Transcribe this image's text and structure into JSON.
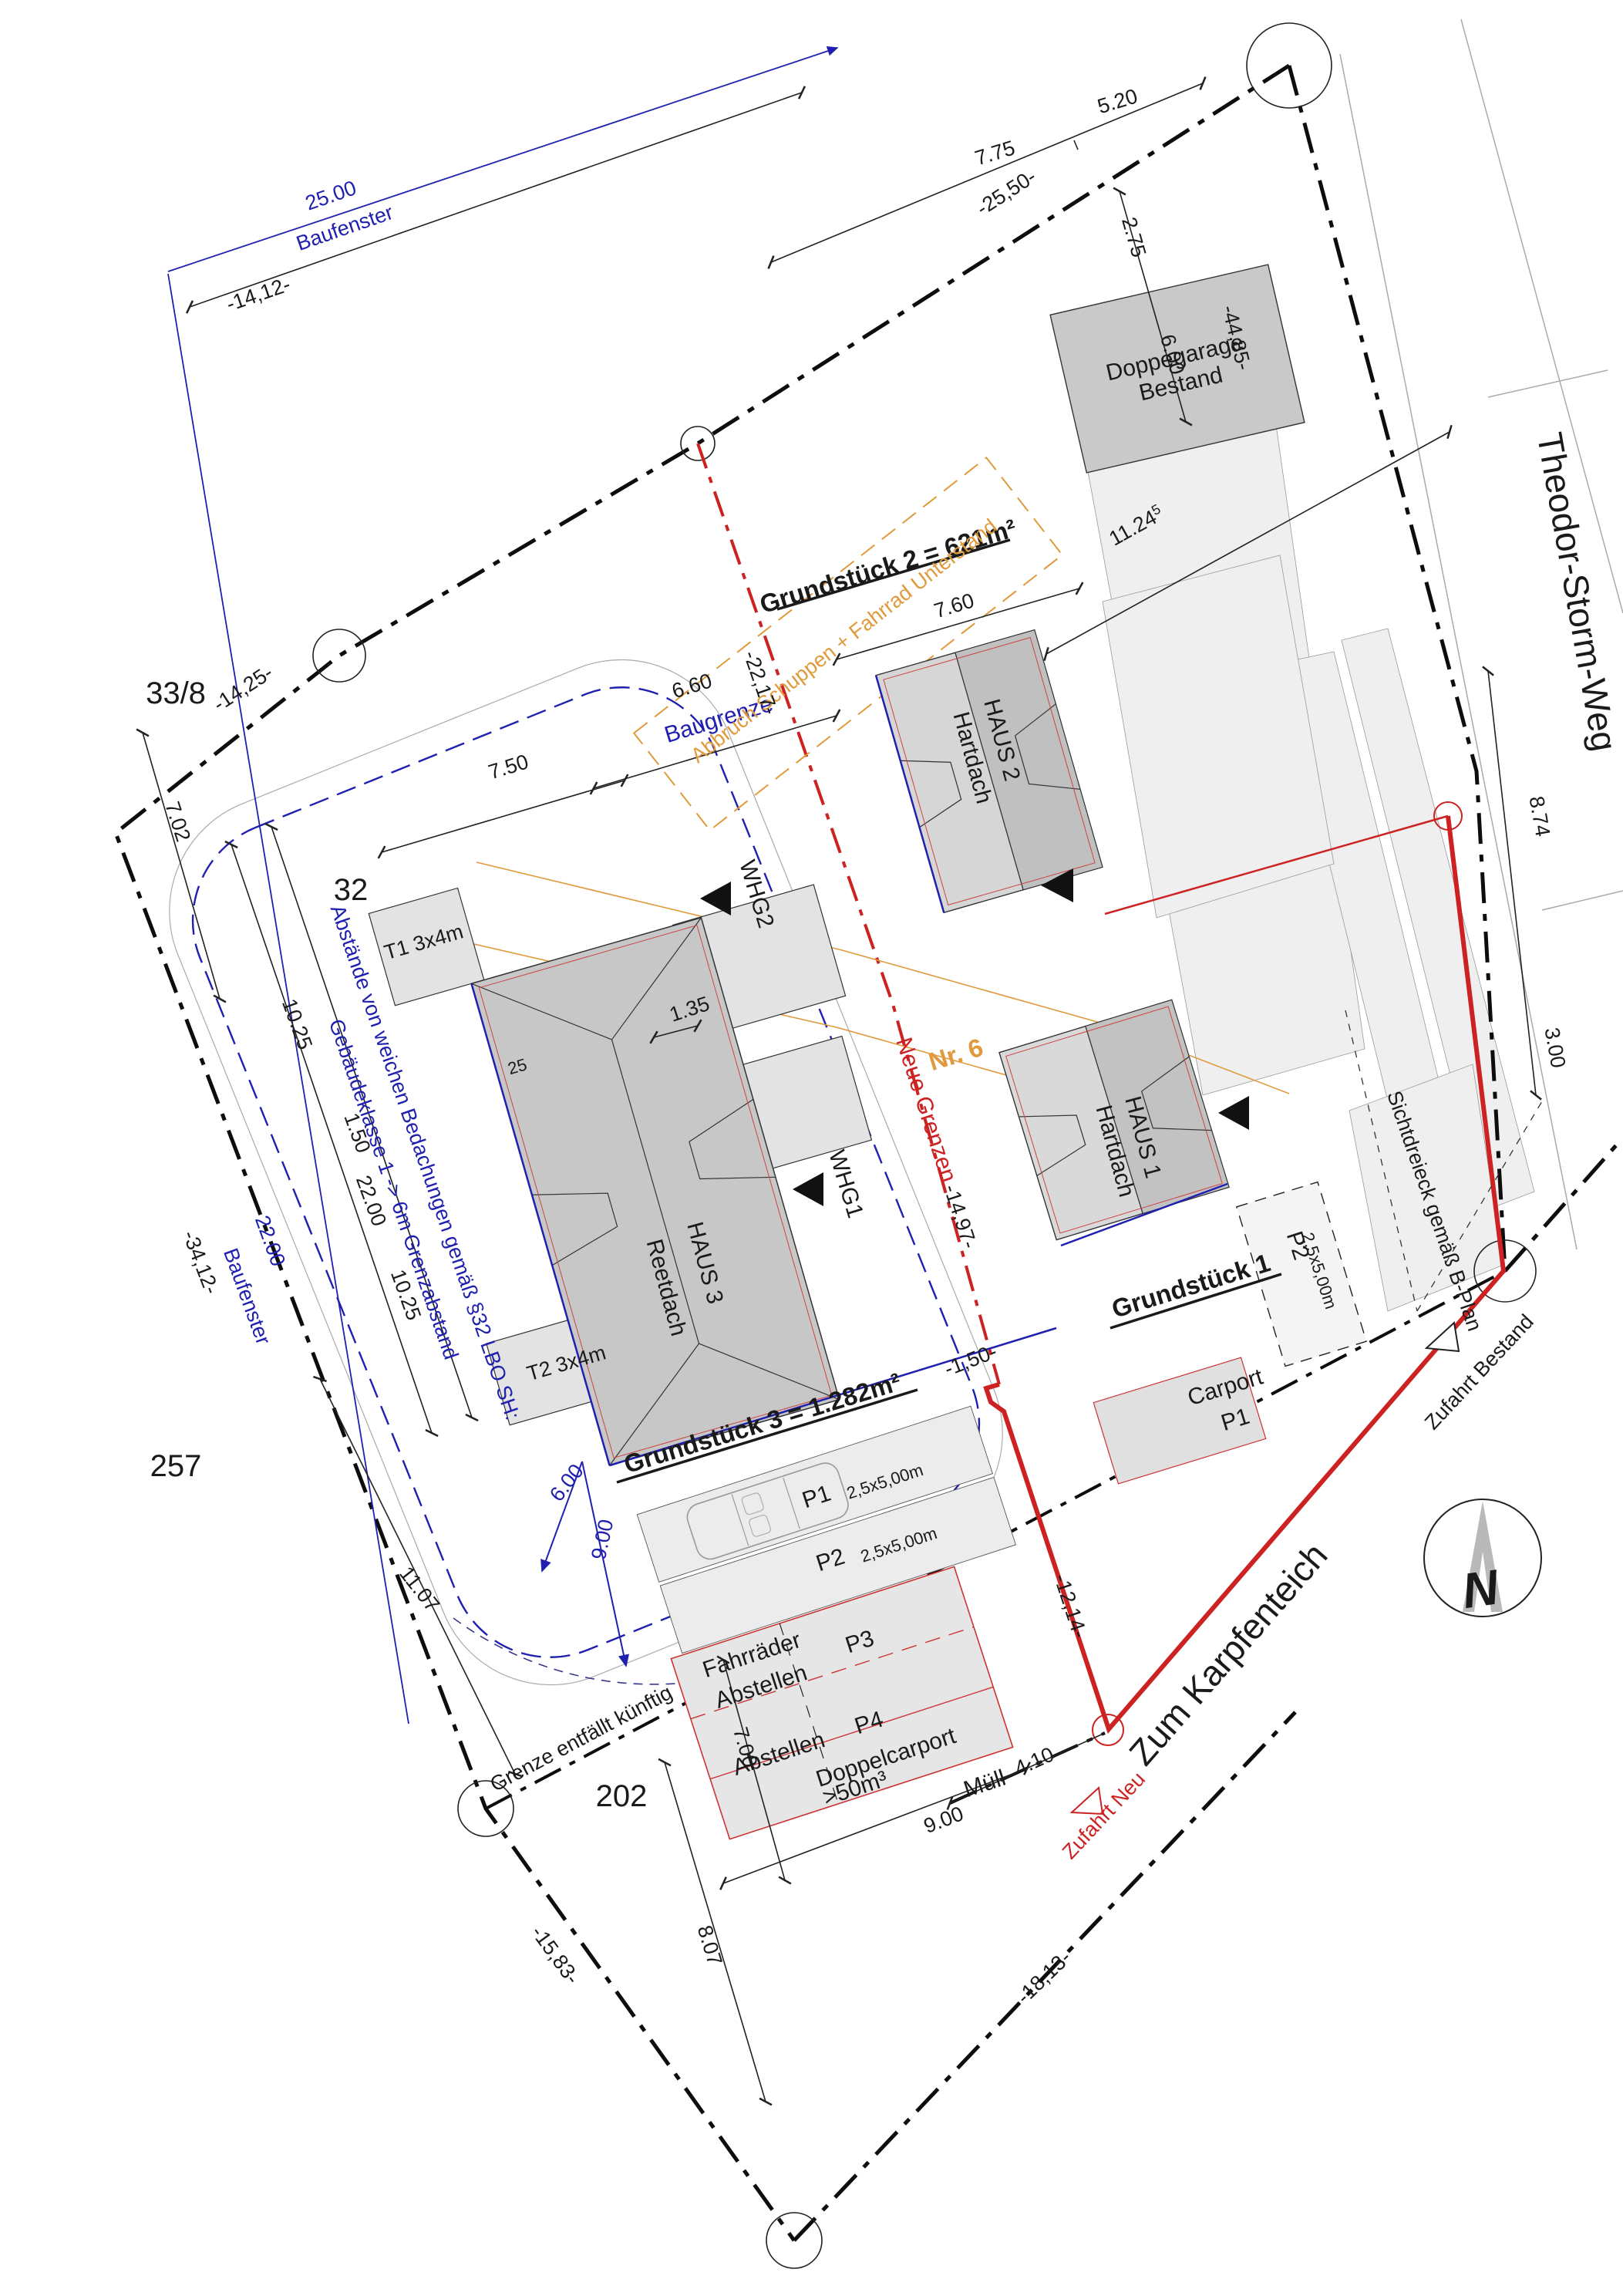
{
  "streets": {
    "north_road": "Theodor-Storm-Weg",
    "south_road": "Zum Karpfenteich"
  },
  "parcel_numbers": {
    "nw": "33/8",
    "w": "257",
    "s": "202",
    "inner": "32"
  },
  "plots": {
    "g1": "Grundstück 1",
    "g2": "Grundstück 2 = 621m²",
    "g3": "Grundstück 3 = 1.282m²",
    "house_no": "Nr. 6"
  },
  "buildings": {
    "haus1": {
      "name": "HAUS 1",
      "roof": "Hartdach"
    },
    "haus2": {
      "name": "HAUS 2",
      "roof": "Hartdach"
    },
    "haus3": {
      "name": "HAUS 3",
      "roof": "Reetdach"
    },
    "garage": {
      "line1": "Doppegarage",
      "line2": "Bestand"
    },
    "whg1": "WHG1",
    "whg2": "WHG2",
    "terrace1": "T1 3x4m",
    "terrace2": "T2 3x4m"
  },
  "parking": {
    "p1": {
      "id": "P1",
      "size": "2,5x5,00m"
    },
    "p2": {
      "id": "P2",
      "size": "2,5x5,00m"
    },
    "p2_haus1": {
      "id": "P2",
      "size": "2,5x5,00m"
    },
    "p3": "P3",
    "p4": {
      "id": "P4",
      "type": "Doppelcarport",
      "volume": ">50m³"
    },
    "carport": {
      "name": "Carport",
      "stall": "P1"
    },
    "bike1": "Fahrräder",
    "bike2": "Abstellen",
    "storage": "Abstellen",
    "waste": "Müll"
  },
  "notes": {
    "baugrenze": "Baugrenze",
    "baufenster_top_value": "25.00",
    "baufenster_top_label": "Baufenster",
    "baufenster_left_value": "22.00",
    "baufenster_left_label": "Baufenster",
    "demolition": "Abbruch Schuppen + Fahrrad Unterstand",
    "setback1": "Abstände von weichen Bedachungen gemäß §32 LBO SH:",
    "setback2": "Gebäudeklasse 1 -> 6m Grenzabstand",
    "new_borders": "Neue Grenzen",
    "old_border": "Grenze entfällt künftig",
    "sight_triangle": "Sichtdreieck gemäß B-Plan",
    "access_existing": "Zufahrt Bestand",
    "access_new": "Zufahrt Neu",
    "north": "N"
  },
  "dimensions": {
    "top": {
      "d1": "5.20",
      "d2": "7.75",
      "d3": "-25,50-",
      "d4": "2.75",
      "d5": "6.00",
      "d6": "-44,85-",
      "d7": "11.24",
      "d7sup": "5",
      "d8": "7.60"
    },
    "right": {
      "d1": "8.74",
      "d2": "3.00"
    },
    "left": {
      "d1": "-14,12-",
      "d2": "-14,25-",
      "d3": "7.02",
      "d4": "-34,12-",
      "d5": "10.25",
      "d6": "1.50",
      "d7": "22.00",
      "d8": "10.25",
      "d9": "7.50",
      "d10": "6.60",
      "d11": "11.07"
    },
    "inner": {
      "d1": "-22,17-",
      "d2": "1.35",
      "d3": "25",
      "d4": "-14,97-",
      "d5": "-1,50-",
      "d6": "6.00",
      "d7": "9.00"
    },
    "bottom": {
      "d1": "7.00",
      "d2": "9.00",
      "d3": "8.07",
      "d4": "-15,83-",
      "d5": "-18,13-",
      "d6": "4.10",
      "d7": "-12,14-"
    }
  },
  "colors": {
    "boundary": "#0d0d0d",
    "new_border": "#cc2222",
    "planning_blue": "#2020b0",
    "demolition_orange": "#e09a3c",
    "roof_gray": "#c9c9c9"
  }
}
